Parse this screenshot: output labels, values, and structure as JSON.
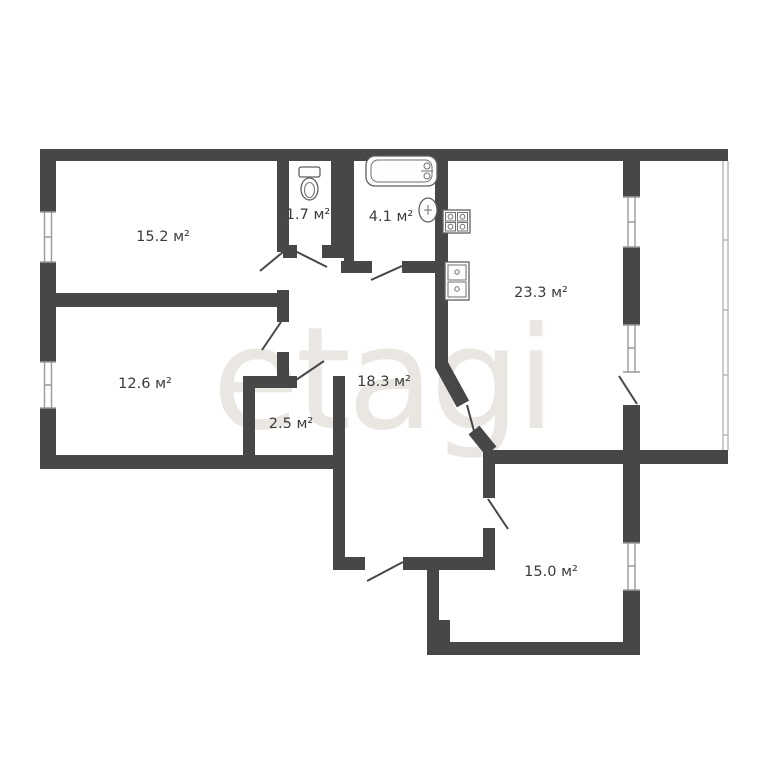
{
  "plan": {
    "title": "apartment-floor-plan",
    "watermark": "etagi",
    "rooms": [
      {
        "name": "room-15-2",
        "label": "15.2 м²"
      },
      {
        "name": "wc-1-7",
        "label": "1.7 м²"
      },
      {
        "name": "bathroom-4-1",
        "label": "4.1 м²"
      },
      {
        "name": "kitchen-living-23-3",
        "label": "23.3 м²"
      },
      {
        "name": "room-12-6",
        "label": "12.6 м²"
      },
      {
        "name": "storage-2-5",
        "label": "2.5 м²"
      },
      {
        "name": "hallway-18-3",
        "label": "18.3 м²"
      },
      {
        "name": "room-15-0",
        "label": "15.0 м²"
      }
    ],
    "fixtures": [
      "toilet-icon",
      "bathtub-icon",
      "washbasin-icon",
      "stove-icon",
      "kitchen-sink-icon"
    ],
    "features": [
      "windows",
      "door-swings",
      "balcony-glazing"
    ],
    "colors": {
      "wall": "#474747",
      "window_line": "#9a9a9a",
      "label_text": "#3b3b3b",
      "watermark": "#eae7e3",
      "background": "#ffffff"
    }
  }
}
